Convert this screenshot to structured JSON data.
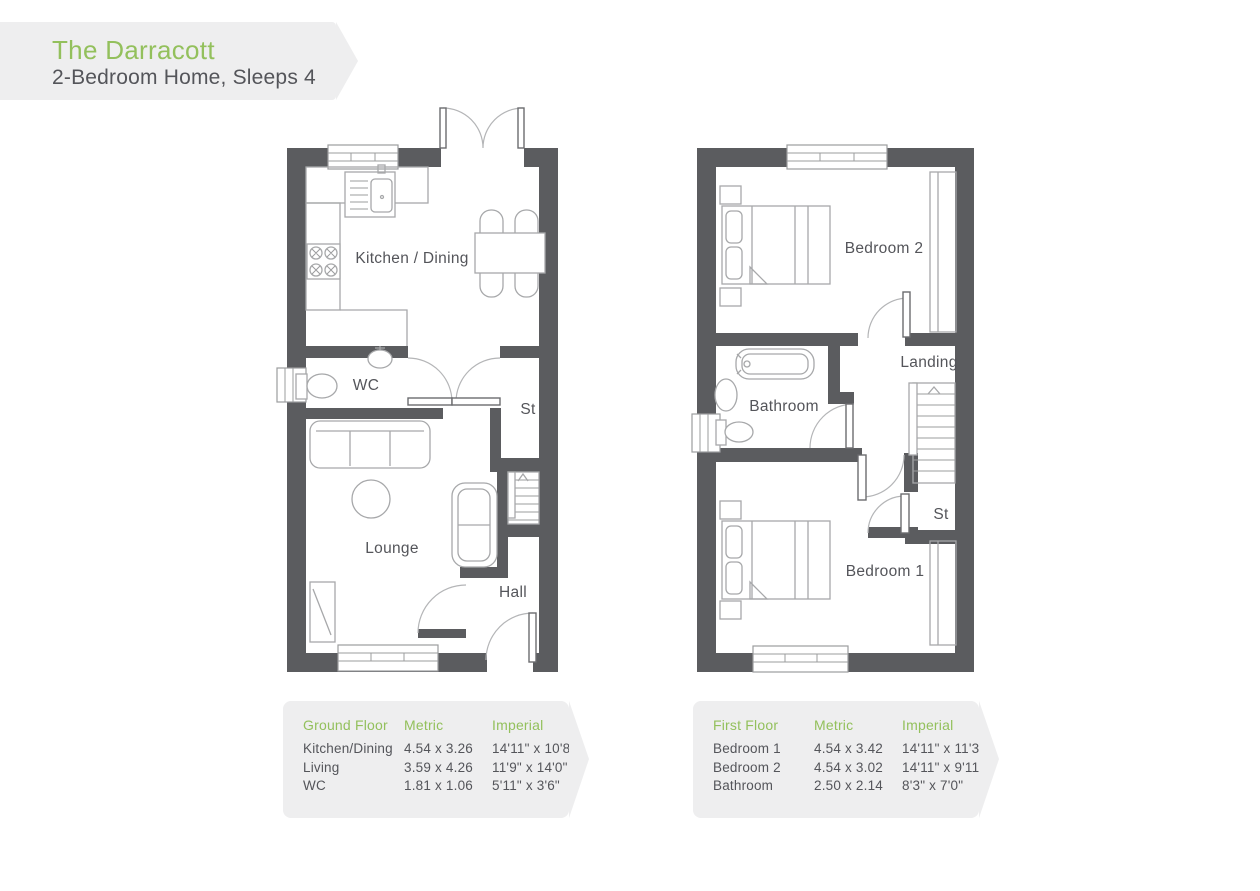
{
  "banner": {
    "title": "The Darracott",
    "subtitle": "2-Bedroom Home, Sleeps 4"
  },
  "colors": {
    "accent_green": "#93c05c",
    "wall_grey": "#5b5c5f",
    "text_grey": "#54555a",
    "panel_bg": "#eeeeef",
    "fixture_line": "#a7a8aa"
  },
  "plans": {
    "ground": {
      "labels": {
        "kitchen_dining": "Kitchen / Dining",
        "wc": "WC",
        "store": "St",
        "lounge": "Lounge",
        "hall": "Hall"
      }
    },
    "first": {
      "labels": {
        "bedroom2": "Bedroom 2",
        "landing": "Landing",
        "bathroom": "Bathroom",
        "store": "St",
        "bedroom1": "Bedroom 1"
      }
    }
  },
  "tables": {
    "ground": {
      "floor_label": "Ground Floor",
      "metric_label": "Metric",
      "imperial_label": "Imperial",
      "rows": [
        {
          "room": "Kitchen/Dining",
          "metric": "4.54 x 3.26",
          "imperial": "14'11\" x 10'8\""
        },
        {
          "room": "Living",
          "metric": "3.59 x 4.26",
          "imperial": "11'9\" x 14'0\""
        },
        {
          "room": "WC",
          "metric": "1.81 x 1.06",
          "imperial": "5'11\" x 3'6\""
        }
      ]
    },
    "first": {
      "floor_label": "First Floor",
      "metric_label": "Metric",
      "imperial_label": "Imperial",
      "rows": [
        {
          "room": "Bedroom 1",
          "metric": "4.54 x 3.42",
          "imperial": "14'11\" x 11'3\""
        },
        {
          "room": "Bedroom 2",
          "metric": "4.54 x 3.02",
          "imperial": "14'11\" x 9'11\""
        },
        {
          "room": "Bathroom",
          "metric": "2.50 x 2.14",
          "imperial": "8'3\" x 7'0\""
        }
      ]
    }
  }
}
